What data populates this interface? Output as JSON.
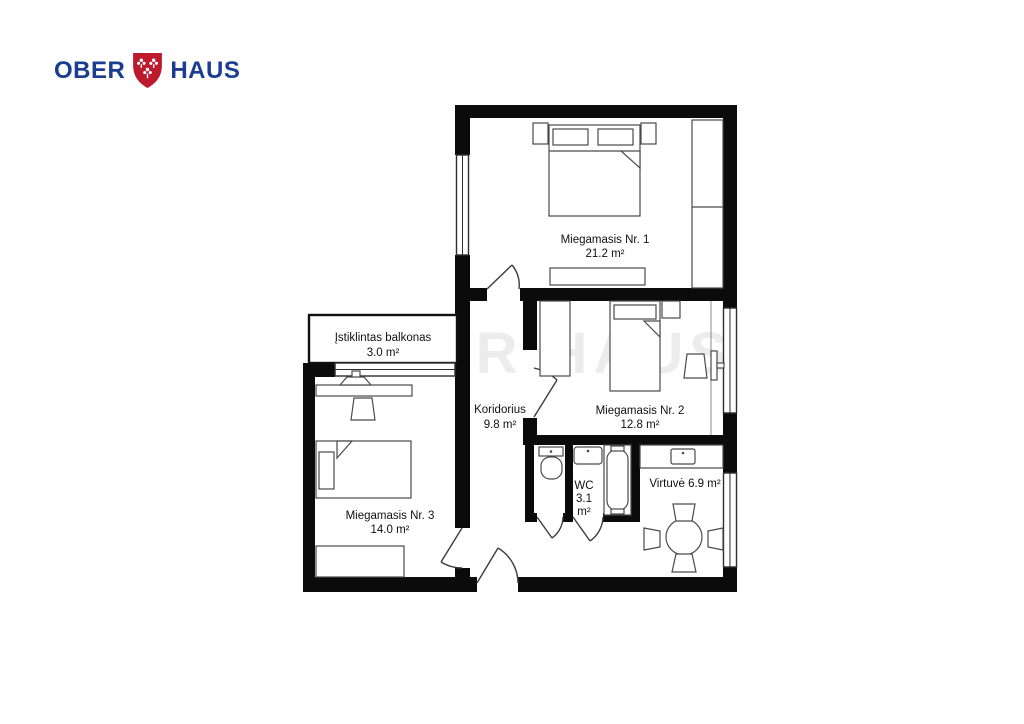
{
  "logo": {
    "brand_left": "OBER",
    "brand_right": "HAUS",
    "text_color": "#1b3d91",
    "shield_color": "#bd1a2d"
  },
  "watermark": "OBER HAUS",
  "rooms": {
    "bedroom1": {
      "name": "Miegamasis Nr. 1",
      "area": "21.2 m²"
    },
    "bedroom2": {
      "name": "Miegamasis Nr. 2",
      "area": "12.8 m²"
    },
    "bedroom3": {
      "name": "Miegamasis Nr. 3",
      "area": "14.0 m²"
    },
    "balcony": {
      "name": "Įstiklintas balkonas",
      "area": "3.0 m²"
    },
    "corridor": {
      "name": "Koridorius",
      "area": "9.8 m²"
    },
    "wc": {
      "name": "WC",
      "area": "3.1",
      "unit": "m²"
    },
    "kitchen": {
      "label": "Virtuvė 6.9 m²"
    }
  }
}
